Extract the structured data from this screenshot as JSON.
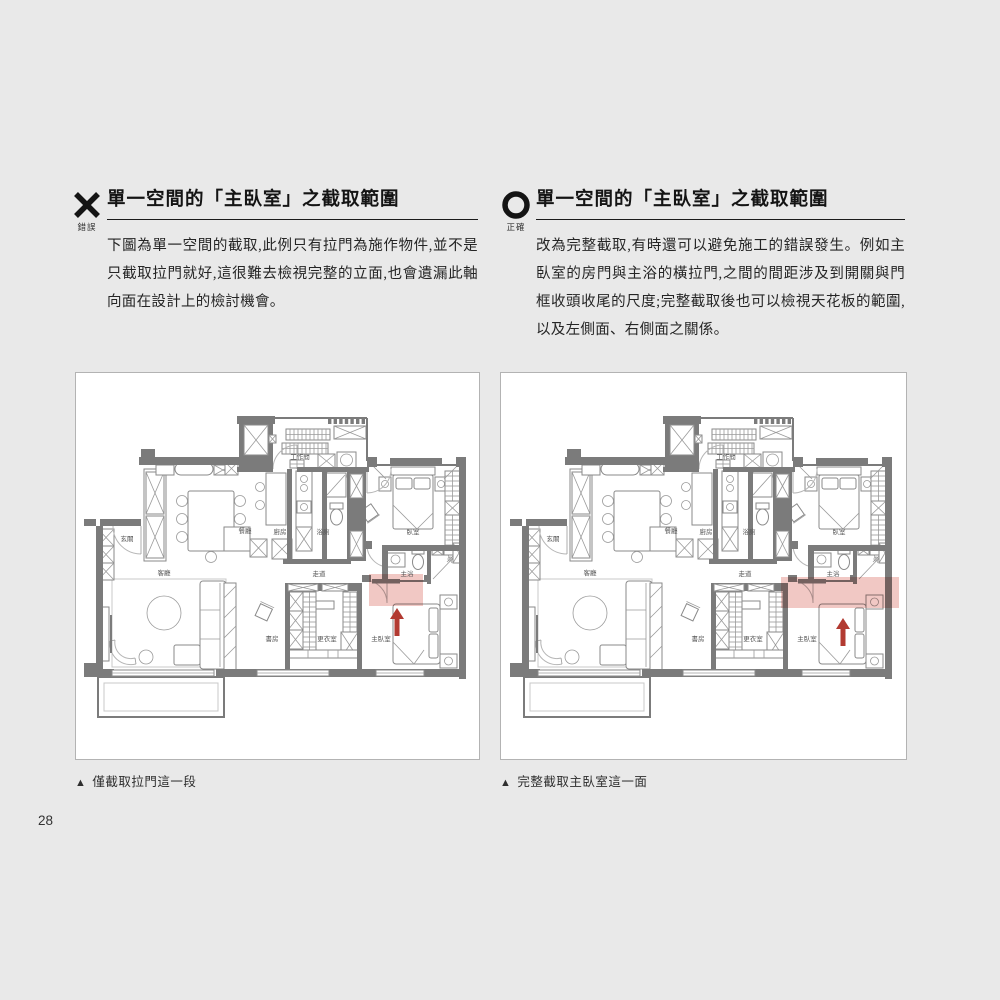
{
  "page": {
    "number": "28",
    "background": "#e9e9e9"
  },
  "columns": [
    {
      "id": "wrong",
      "icon": "x-icon",
      "icon_label": "錯誤",
      "title": "單一空間的「主臥室」之截取範圍",
      "body": "下圖為單一空間的截取,此例只有拉門為施作物件,並不是只截取拉門就好,這很難去檢視完整的立面,也會遺漏此軸向面在設計上的檢討機會。",
      "caption_marker": "▲",
      "caption": "僅截取拉門這一段",
      "highlight": {
        "x": 293,
        "y": 201,
        "w": 54,
        "h": 32
      },
      "arrow": {
        "x": 321,
        "tip": 235,
        "base": 263
      }
    },
    {
      "id": "correct",
      "icon": "o-icon",
      "icon_label": "正確",
      "title": "單一空間的「主臥室」之截取範圍",
      "body": "改為完整截取,有時還可以避免施工的錯誤發生。例如主臥室的房門與主浴的橫拉門,之間的間距涉及到開關與門框收頭收尾的尺度;完整截取後也可以檢視天花板的範圍,以及左側面、右側面之關係。",
      "caption_marker": "▲",
      "caption": "完整截取主臥室這一面",
      "highlight": {
        "x": 279,
        "y": 204,
        "w": 118,
        "h": 31
      },
      "arrow": {
        "x": 341,
        "tip": 245,
        "base": 273
      }
    }
  ],
  "floorplan": {
    "rooms": [
      {
        "name": "玄關",
        "x": 51,
        "y": 168
      },
      {
        "name": "客廳",
        "x": 88,
        "y": 202
      },
      {
        "name": "餐廳",
        "x": 169,
        "y": 160
      },
      {
        "name": "廚房",
        "x": 204,
        "y": 161
      },
      {
        "name": "浴廁",
        "x": 247,
        "y": 161
      },
      {
        "name": "臥室",
        "x": 337,
        "y": 161
      },
      {
        "name": "工作間",
        "x": 224,
        "y": 86
      },
      {
        "name": "走道",
        "x": 243,
        "y": 203
      },
      {
        "name": "主浴",
        "x": 331,
        "y": 203
      },
      {
        "name": "書房",
        "x": 196,
        "y": 268
      },
      {
        "name": "更衣室",
        "x": 251,
        "y": 268
      },
      {
        "name": "主臥室",
        "x": 305,
        "y": 268
      }
    ],
    "colors": {
      "wall": "#7b7b7b",
      "furniture": "#9a9a9a",
      "highlight": "#e59b94",
      "arrow": "#b23a31"
    }
  }
}
